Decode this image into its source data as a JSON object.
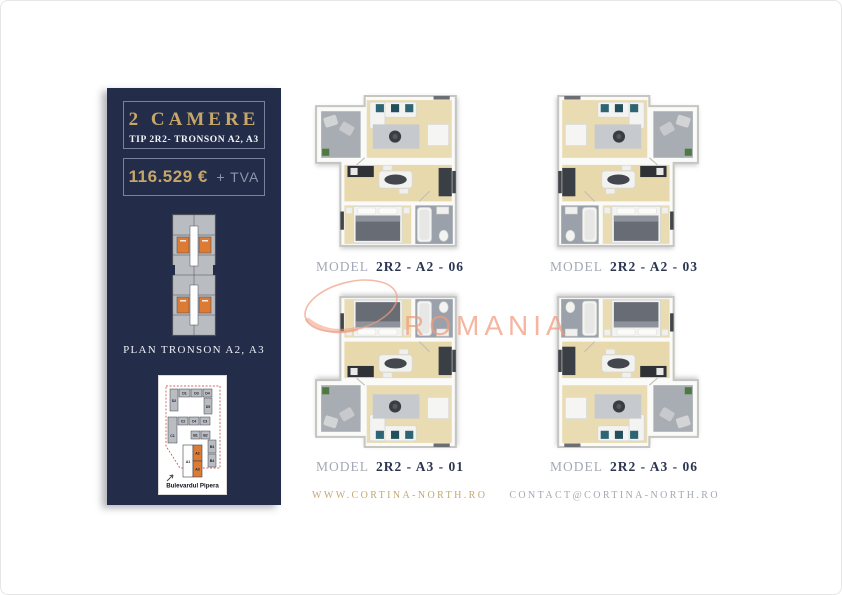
{
  "sidebar": {
    "title": "2 CAMERE",
    "subtitle": "TIP 2R2- TRONSON A2, A3",
    "price": "116.529 €",
    "price_suffix": "+ TVA",
    "plan_label": "PLAN TRONSON A2, A3",
    "site_map": {
      "street_label": "Bulevardul Pipera",
      "labels": [
        "D2",
        "D1",
        "D3",
        "D4",
        "D5",
        "C2",
        "C4",
        "C3",
        "C1",
        "B1",
        "B2",
        "B3",
        "B4",
        "A1",
        "A2",
        "A3"
      ]
    },
    "colors": {
      "background": "#232c49",
      "gold": "#c6a768",
      "muted_gray": "#8d96a9",
      "highlight_orange": "#dd7a33"
    }
  },
  "plans": [
    {
      "model_prefix": "MODEL",
      "model": "2R2 - A2 - 06"
    },
    {
      "model_prefix": "MODEL",
      "model": "2R2 - A2 - 03"
    },
    {
      "model_prefix": "MODEL",
      "model": "2R2 - A3 - 01"
    },
    {
      "model_prefix": "MODEL",
      "model": "2R2 - A3 - 06"
    }
  ],
  "footer": {
    "website": "WWW.CORTINA-NORTH.RO",
    "email": "CONTACT@CORTINA-NORTH.RO"
  },
  "watermark": {
    "text": "ROMANIA",
    "color": "#f09b7e"
  }
}
